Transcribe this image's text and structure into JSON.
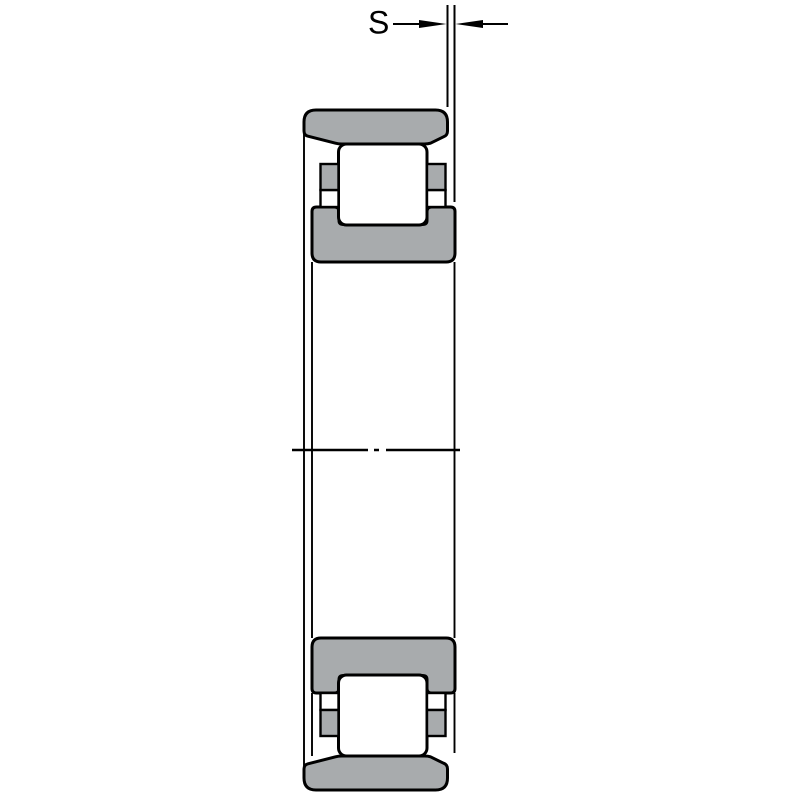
{
  "dimension": {
    "label": "S"
  },
  "colors": {
    "bearing_gray": "#a8abad",
    "outline_black": "#000000",
    "background": "#ffffff"
  }
}
